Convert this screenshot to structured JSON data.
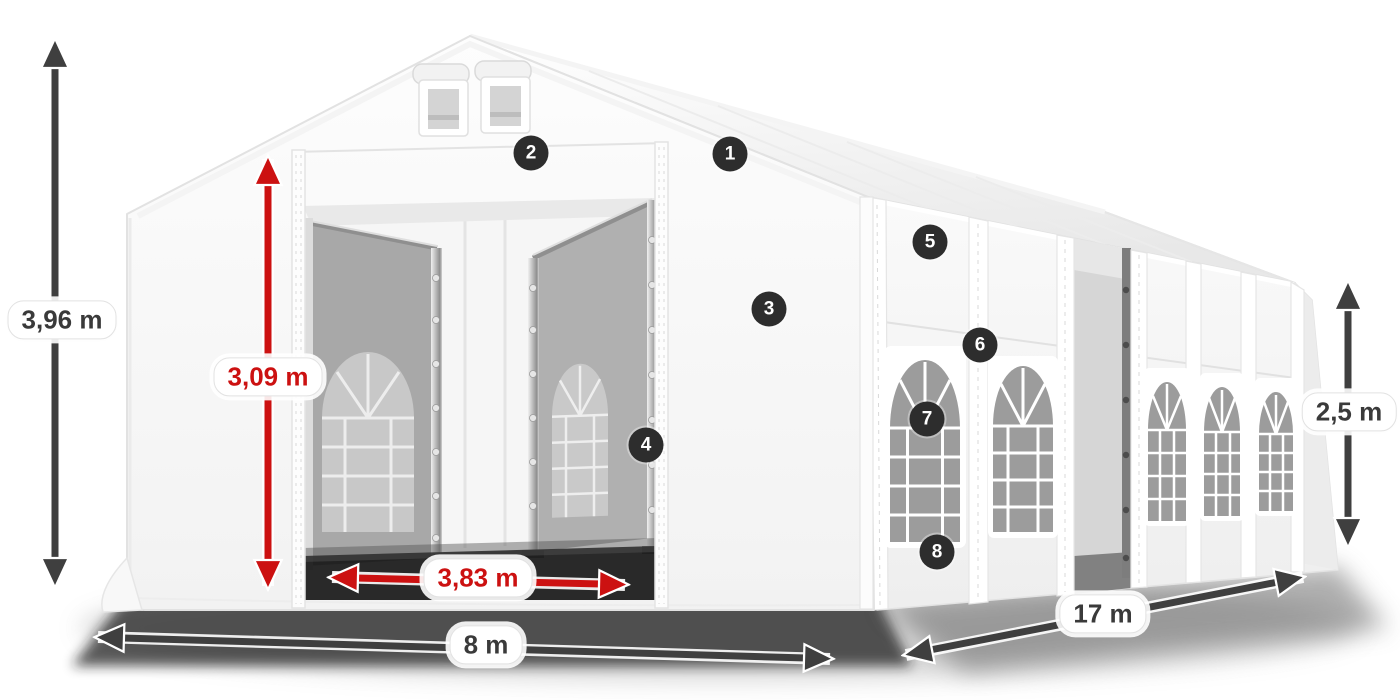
{
  "dimensions": {
    "total_height": {
      "label": "3,96 m",
      "color": "gray"
    },
    "entrance_height": {
      "label": "3,09 m",
      "color": "red"
    },
    "entrance_width": {
      "label": "3,83 m",
      "color": "red"
    },
    "width": {
      "label": "8 m",
      "color": "gray"
    },
    "length": {
      "label": "17 m",
      "color": "gray"
    },
    "side_height": {
      "label": "2,5 m",
      "color": "gray"
    }
  },
  "badges": [
    {
      "number": "1"
    },
    {
      "number": "2"
    },
    {
      "number": "3"
    },
    {
      "number": "4"
    },
    {
      "number": "5"
    },
    {
      "number": "6"
    },
    {
      "number": "7"
    },
    {
      "number": "8"
    }
  ],
  "colors": {
    "dimension_gray": "#3f3f3f",
    "dimension_red": "#cc1111",
    "badge_background": "#2d2d2d",
    "badge_text": "#ffffff",
    "label_text": "#3a3a3a"
  }
}
